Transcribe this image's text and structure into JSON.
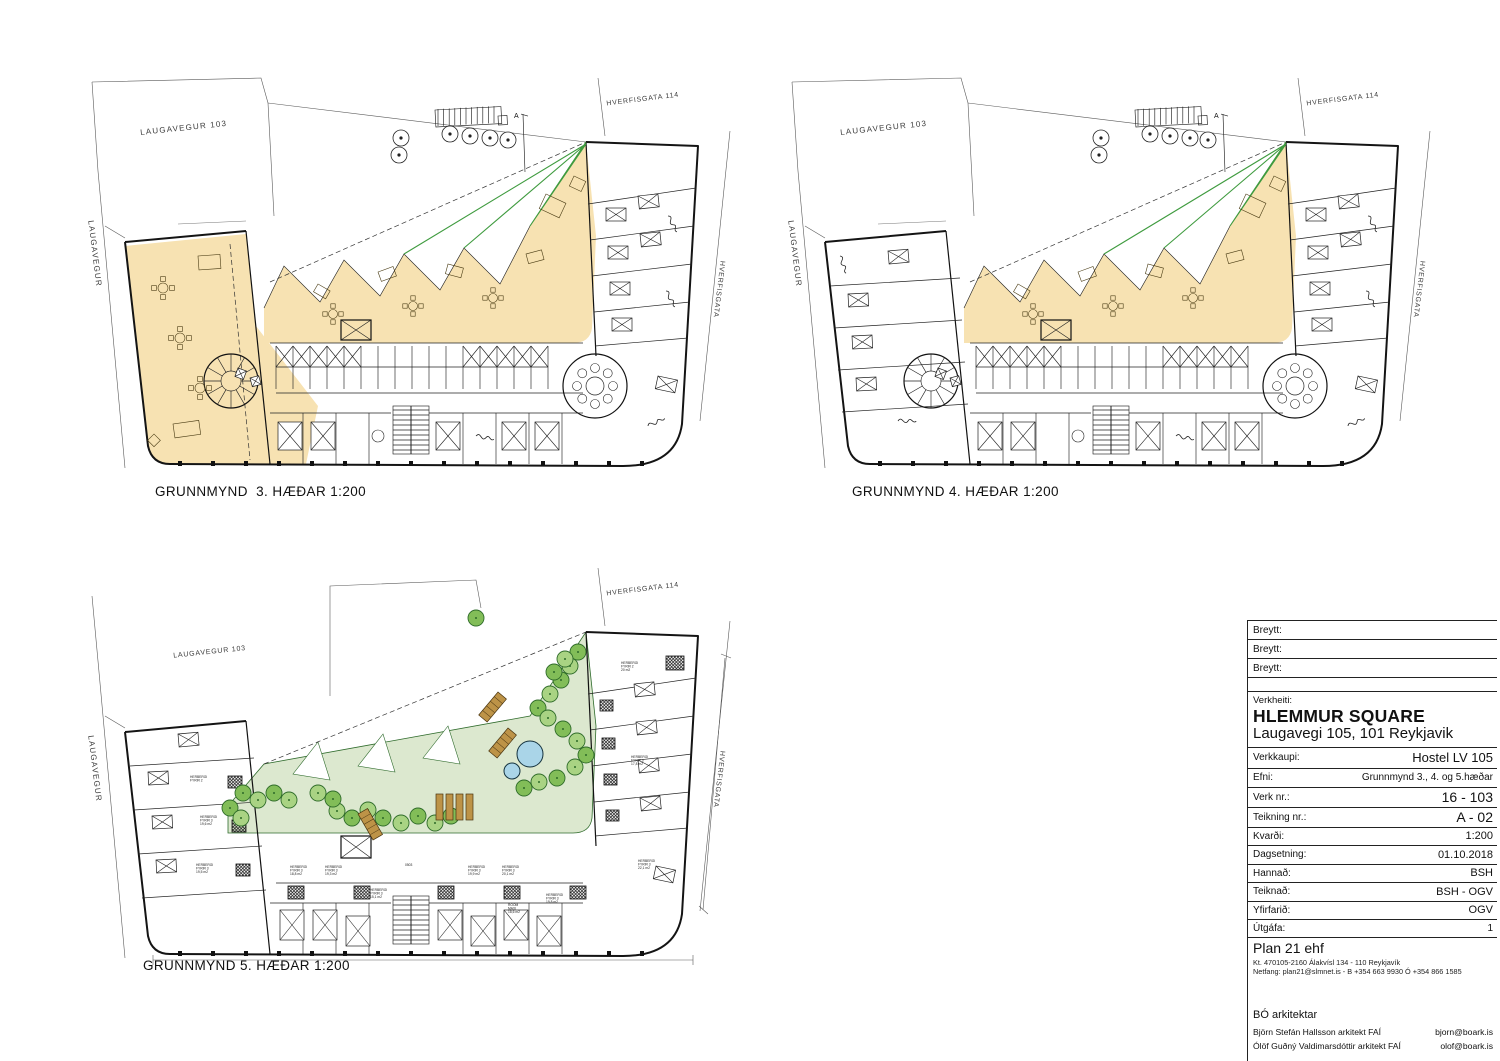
{
  "streets": {
    "laugavegur_103": "LAUGAVEGUR 103",
    "laugavegur": "LAUGAVEGUR",
    "hverfisgata_114": "HVERFISGATA 114",
    "hverfisgata": "HVERFISGATA"
  },
  "section_marker": "A",
  "plans": {
    "floor3": {
      "title": "GRUNNMYND  3. HÆÐAR 1:200",
      "highlight_color": "#f7e2b2"
    },
    "floor4": {
      "title": "GRUNNMYND 4. HÆÐAR 1:200",
      "highlight_color": "#f7e2b2"
    },
    "floor5": {
      "title": "GRUNNMYND 5. HÆÐAR 1:200",
      "terrace_color": "#dce8cf",
      "tree_colors": [
        "#82bd58",
        "#a9d383"
      ],
      "pool_color": "#aad5e8",
      "bench_color": "#bd9347",
      "room_labels": [
        {
          "text": "HERBERGI|FYRIR 2",
          "x": 112,
          "y": 212
        },
        {
          "text": "HERBERGI|FYRIR 3|19,6 m2",
          "x": 122,
          "y": 252
        },
        {
          "text": "HERBERGI|FYRIR 3|19,5 m2",
          "x": 118,
          "y": 300
        },
        {
          "text": "HERBERGI|FYRIR 3|18,8 m2",
          "x": 212,
          "y": 302
        },
        {
          "text": "HERBERGI|FYRIR 3|19,3 m2",
          "x": 247,
          "y": 302
        },
        {
          "text": "0503",
          "x": 327,
          "y": 300
        },
        {
          "text": "HERBERGI|FYRIR 3|15,1 m2",
          "x": 292,
          "y": 325
        },
        {
          "text": "HERBERGI|FYRIR 3|19,9 m2",
          "x": 390,
          "y": 302
        },
        {
          "text": "HERBERGI|FYRIR 3|20,1 m2",
          "x": 424,
          "y": 302
        },
        {
          "text": "ROOM|MAXI|18,6 m2",
          "x": 430,
          "y": 340
        },
        {
          "text": "HERBERGI|FYRIR 3|19,8 m2",
          "x": 468,
          "y": 330
        },
        {
          "text": "HERBERGI|FYRIR 3|22,1 m2",
          "x": 560,
          "y": 296
        },
        {
          "text": "HERBERGI|FYRIR 3|17,8 m2",
          "x": 553,
          "y": 192
        },
        {
          "text": "HERBERGI|FYRIR 2|20 m2",
          "x": 543,
          "y": 98
        }
      ]
    }
  },
  "titleblock": {
    "revisions": [
      {
        "label": "Breytt:"
      },
      {
        "label": "Breytt:"
      },
      {
        "label": "Breytt:"
      }
    ],
    "project": {
      "label": "Verkheiti:",
      "name": "HLEMMUR SQUARE",
      "address": "Laugavegi 105, 101 Reykjavik"
    },
    "fields": [
      {
        "label": "Verkkaupi:",
        "value": "Hostel LV 105"
      },
      {
        "label": "Efni:",
        "value": "Grunnmynd 3., 4. og 5.hæðar"
      },
      {
        "label": "Verk nr.:",
        "value": "16 - 103"
      },
      {
        "label": "Teikning nr.:",
        "value": "A - 02"
      },
      {
        "label": "Kvarði:",
        "value": "1:200"
      },
      {
        "label": "Dagsetning:",
        "value": "01.10.2018"
      },
      {
        "label": "Hannað:",
        "value": "BSH"
      },
      {
        "label": "Teiknað:",
        "value": "BSH - OGV"
      },
      {
        "label": "Yfirfarið:",
        "value": "OGV"
      },
      {
        "label": "Útgáfa:",
        "value": "1"
      }
    ],
    "company": {
      "name": "Plan 21 ehf",
      "registration": "Kt. 470105-2160 Álakvísl 134 - 110 Reykjavík",
      "contact": "Netfang: plan21@slmnet.is - B +354 663 9930 Ó +354 866 1585"
    },
    "architects": {
      "heading": "BÓ arkitektar",
      "people": [
        {
          "name": "Björn Stefán Hallsson arkitekt FAÍ",
          "email": "bjorn@boark.is"
        },
        {
          "name": "Ólöf Guðný Valdimarsdóttir arkitekt FAÍ",
          "email": "olof@boark.is"
        }
      ]
    }
  }
}
